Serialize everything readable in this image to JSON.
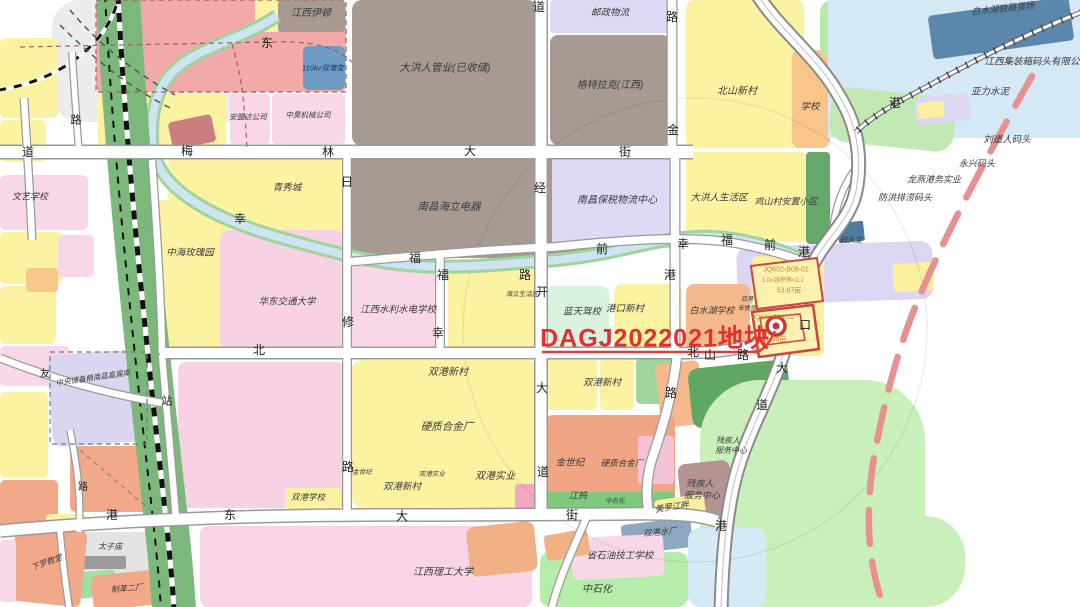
{
  "meta": {
    "title": "城市规划地块示意图",
    "highlight_parcel_label": "DAGJ2022021地块",
    "parcels": [
      {
        "code": "JQ602-B08-01",
        "far": "1.0<容积率<2.2",
        "area": "53.67亩"
      },
      {
        "code": "JQ602-B08-02",
        "area": "39.99亩"
      }
    ]
  },
  "colors": {
    "highlight": "#e23030",
    "parcel_outline": "#cc4444",
    "red_dashed": "#e89090",
    "river": "#cfe4f2",
    "river_bank": "#9fd49a",
    "railway_green": "#7cb87c",
    "road": "#ffffff",
    "road_casing": "#9a9a9a"
  },
  "blocks": [
    {
      "x": 52,
      "y": 0,
      "w": 205,
      "h": 122,
      "c": "#ececec",
      "r": 28,
      "n": "rail-yard"
    },
    {
      "x": 0,
      "y": 38,
      "w": 58,
      "h": 80,
      "c": "#fcf3a2",
      "r": 6
    },
    {
      "x": 0,
      "y": 120,
      "w": 46,
      "h": 42,
      "c": "#fcf3a2",
      "r": 6
    },
    {
      "x": 96,
      "y": 0,
      "w": 250,
      "h": 92,
      "c": "#f1a9a9",
      "r": 6
    },
    {
      "x": 255,
      "y": 0,
      "w": 24,
      "h": 32,
      "c": "#fcf3a2",
      "r": 3
    },
    {
      "x": 278,
      "y": 0,
      "w": 67,
      "h": 32,
      "c": "#a79a92",
      "r": 4
    },
    {
      "x": 303,
      "y": 46,
      "w": 42,
      "h": 44,
      "c": "#6d9cc4",
      "r": 6
    },
    {
      "x": 98,
      "y": 94,
      "w": 128,
      "h": 52,
      "c": "#fcf3a2",
      "r": 4
    },
    {
      "x": 230,
      "y": 94,
      "w": 40,
      "h": 50,
      "c": "#f8d8e8",
      "r": 4
    },
    {
      "x": 272,
      "y": 94,
      "w": 73,
      "h": 50,
      "c": "#f8d8e8",
      "r": 4
    },
    {
      "x": 170,
      "y": 118,
      "w": 44,
      "h": 28,
      "c": "#c97f7f",
      "r": 4,
      "a": -12
    },
    {
      "x": 352,
      "y": 0,
      "w": 186,
      "h": 146,
      "c": "#a79a92",
      "r": 10
    },
    {
      "x": 550,
      "y": 0,
      "w": 120,
      "h": 33,
      "c": "#ded9f4",
      "r": 4
    },
    {
      "x": 550,
      "y": 35,
      "w": 120,
      "h": 110,
      "c": "#a79a92",
      "r": 8
    },
    {
      "x": 686,
      "y": 0,
      "w": 118,
      "h": 148,
      "c": "#fcf3a2",
      "r": 8
    },
    {
      "x": 792,
      "y": 50,
      "w": 38,
      "h": 98,
      "c": "#f8c58c",
      "r": 8
    },
    {
      "x": 820,
      "y": 0,
      "w": 70,
      "h": 58,
      "c": "#b9e8ab",
      "r": 12
    },
    {
      "x": 828,
      "y": 0,
      "w": 252,
      "h": 138,
      "c": "#d5e8f5",
      "r": 0,
      "n": "lake"
    },
    {
      "x": 930,
      "y": 6,
      "w": 142,
      "h": 44,
      "c": "#5b87ad",
      "r": 4,
      "a": -8
    },
    {
      "x": 830,
      "y": 92,
      "w": 125,
      "h": 55,
      "c": "#c2e9b4",
      "r": 18,
      "a": 6
    },
    {
      "x": 915,
      "y": 95,
      "w": 55,
      "h": 28,
      "c": "#ddd8f2",
      "r": 8,
      "a": -6
    },
    {
      "x": 918,
      "y": 102,
      "w": 26,
      "h": 16,
      "c": "#faf0a0",
      "r": 3,
      "a": -6
    },
    {
      "x": 168,
      "y": 155,
      "w": 177,
      "h": 92,
      "c": "#fcf3a2",
      "r": 10
    },
    {
      "x": 148,
      "y": 200,
      "w": 100,
      "h": 150,
      "c": "#fcf3a2",
      "r": 12
    },
    {
      "x": 220,
      "y": 230,
      "w": 125,
      "h": 120,
      "c": "#f6d2e4",
      "r": 10
    },
    {
      "x": 352,
      "y": 150,
      "w": 268,
      "h": 108,
      "c": "#a79a92",
      "r": 10
    },
    {
      "x": 552,
      "y": 153,
      "w": 128,
      "h": 95,
      "c": "#ded9f4",
      "r": 8
    },
    {
      "x": 686,
      "y": 152,
      "w": 122,
      "h": 90,
      "c": "#fcf3a2",
      "r": 8
    },
    {
      "x": 806,
      "y": 152,
      "w": 24,
      "h": 92,
      "c": "#66a86a",
      "r": 4
    },
    {
      "x": 737,
      "y": 244,
      "w": 196,
      "h": 58,
      "c": "#dcd6f2",
      "r": 12,
      "a": -2
    },
    {
      "x": 893,
      "y": 263,
      "w": 40,
      "h": 28,
      "c": "#faf0a0",
      "r": 4,
      "a": -4
    },
    {
      "x": 838,
      "y": 222,
      "w": 26,
      "h": 20,
      "c": "#4f7ba3",
      "r": 2,
      "a": -6
    },
    {
      "x": 0,
      "y": 175,
      "w": 88,
      "h": 55,
      "c": "#f8d8e8",
      "r": 6
    },
    {
      "x": 0,
      "y": 232,
      "w": 62,
      "h": 52,
      "c": "#fcf3a2",
      "r": 5
    },
    {
      "x": 0,
      "y": 286,
      "w": 56,
      "h": 58,
      "c": "#fcf3a2",
      "r": 5
    },
    {
      "x": 58,
      "y": 235,
      "w": 36,
      "h": 42,
      "c": "#f8d8e8",
      "r": 5
    },
    {
      "x": 26,
      "y": 268,
      "w": 32,
      "h": 24,
      "c": "#f5c98a",
      "r": 4
    },
    {
      "x": 0,
      "y": 346,
      "w": 70,
      "h": 40,
      "c": "#f8d8e8",
      "r": 5
    },
    {
      "x": 352,
      "y": 262,
      "w": 90,
      "h": 90,
      "c": "#f8d8e8",
      "r": 8
    },
    {
      "x": 448,
      "y": 262,
      "w": 88,
      "h": 90,
      "c": "#fcf3a2",
      "r": 8
    },
    {
      "x": 545,
      "y": 286,
      "w": 64,
      "h": 62,
      "c": "#d9f2e0",
      "r": 8
    },
    {
      "x": 614,
      "y": 284,
      "w": 68,
      "h": 64,
      "c": "#fcf3a2",
      "r": 8
    },
    {
      "x": 686,
      "y": 284,
      "w": 64,
      "h": 68,
      "c": "#f5b98c",
      "r": 8
    },
    {
      "x": 752,
      "y": 256,
      "w": 72,
      "h": 100,
      "c": "#faf0a0",
      "r": 6
    },
    {
      "x": 178,
      "y": 362,
      "w": 167,
      "h": 146,
      "c": "#f6d2e4",
      "r": 8
    },
    {
      "x": 50,
      "y": 352,
      "w": 97,
      "h": 92,
      "c": "#dbd6f0",
      "r": 10,
      "a": -4
    },
    {
      "x": 70,
      "y": 446,
      "w": 82,
      "h": 66,
      "c": "#f2a989",
      "r": 6
    },
    {
      "x": 0,
      "y": 392,
      "w": 48,
      "h": 86,
      "c": "#fcf3a2",
      "r": 5
    },
    {
      "x": 0,
      "y": 480,
      "w": 58,
      "h": 52,
      "c": "#f2a989",
      "r": 5
    },
    {
      "x": 46,
      "y": 514,
      "w": 40,
      "h": 22,
      "c": "#fcf3a2",
      "r": 4
    },
    {
      "x": 352,
      "y": 360,
      "w": 185,
      "h": 148,
      "c": "#fcf3a2",
      "r": 10
    },
    {
      "x": 515,
      "y": 484,
      "w": 24,
      "h": 26,
      "c": "#f2a8c0",
      "r": 3
    },
    {
      "x": 545,
      "y": 358,
      "w": 52,
      "h": 52,
      "c": "#fcf3a2",
      "r": 6
    },
    {
      "x": 600,
      "y": 358,
      "w": 34,
      "h": 52,
      "c": "#fcf3a2",
      "r": 6
    },
    {
      "x": 636,
      "y": 358,
      "w": 42,
      "h": 46,
      "c": "#9ed69e",
      "r": 5
    },
    {
      "x": 658,
      "y": 362,
      "w": 44,
      "h": 64,
      "c": "#f5b98c",
      "r": 6,
      "a": -6
    },
    {
      "x": 690,
      "y": 364,
      "w": 100,
      "h": 60,
      "c": "#5fa763",
      "r": 10,
      "a": -6
    },
    {
      "x": 545,
      "y": 415,
      "w": 130,
      "h": 96,
      "c": "#f0a585",
      "r": 8
    },
    {
      "x": 545,
      "y": 492,
      "w": 130,
      "h": 20,
      "c": "#7fc87f",
      "r": 4
    },
    {
      "x": 638,
      "y": 436,
      "w": 36,
      "h": 48,
      "c": "#f3c3d8",
      "r": 4
    },
    {
      "x": 700,
      "y": 380,
      "w": 225,
      "h": 235,
      "c": "#c9f0bb",
      "r": 60
    },
    {
      "x": 700,
      "y": 516,
      "w": 265,
      "h": 91,
      "c": "#c9f0bb",
      "r": 40
    },
    {
      "x": 680,
      "y": 462,
      "w": 52,
      "h": 58,
      "c": "#b49393",
      "r": 8,
      "a": -6
    },
    {
      "x": 655,
      "y": 497,
      "w": 50,
      "h": 20,
      "c": "#faf0a0",
      "r": 4,
      "a": -8
    },
    {
      "x": 622,
      "y": 521,
      "w": 70,
      "h": 30,
      "c": "#8fa8c0",
      "r": 4,
      "a": -7
    },
    {
      "x": 688,
      "y": 528,
      "w": 78,
      "h": 79,
      "c": "#d6e9f6",
      "r": 12
    },
    {
      "x": 540,
      "y": 552,
      "w": 148,
      "h": 55,
      "c": "#b4eeaa",
      "r": 10
    },
    {
      "x": 572,
      "y": 536,
      "w": 92,
      "h": 42,
      "c": "#f8d8e8",
      "r": 6,
      "a": -3
    },
    {
      "x": 200,
      "y": 526,
      "w": 332,
      "h": 81,
      "c": "#f8d5e6",
      "r": 8
    },
    {
      "x": 468,
      "y": 524,
      "w": 68,
      "h": 50,
      "c": "#f2b185",
      "r": 8,
      "a": -6
    },
    {
      "x": 545,
      "y": 532,
      "w": 44,
      "h": 26,
      "c": "#f2b185",
      "r": 4,
      "a": -10
    },
    {
      "x": 62,
      "y": 532,
      "w": 102,
      "h": 44,
      "c": "#e3e3e3",
      "r": 8
    },
    {
      "x": 80,
      "y": 556,
      "w": 46,
      "h": 13,
      "c": "#9a9a9a",
      "r": 2
    },
    {
      "x": 58,
      "y": 572,
      "w": 58,
      "h": 26,
      "c": "#9fe09f",
      "r": 4,
      "a": -6
    },
    {
      "x": 92,
      "y": 572,
      "w": 78,
      "h": 35,
      "c": "#f2a989",
      "r": 6,
      "a": -6
    },
    {
      "x": 12,
      "y": 528,
      "w": 72,
      "h": 76,
      "c": "#f2a989",
      "r": 6,
      "a": 6
    },
    {
      "x": 0,
      "y": 540,
      "w": 16,
      "h": 62,
      "c": "#f8d8e8",
      "r": 3
    },
    {
      "x": 285,
      "y": 488,
      "w": 56,
      "h": 22,
      "c": "#fcf3a2",
      "r": 4
    }
  ],
  "labels": [
    {
      "t": "道",
      "x": 28,
      "y": 152,
      "s": 12,
      "c": "#1c1c1c"
    },
    {
      "t": "路",
      "x": 76,
      "y": 121,
      "s": 11,
      "c": "#1c1c1c"
    },
    {
      "t": "东",
      "x": 267,
      "y": 43,
      "s": 12,
      "c": "#1c1c1c"
    },
    {
      "t": "梅",
      "x": 187,
      "y": 151,
      "s": 12,
      "c": "#1c1c1c"
    },
    {
      "t": "林",
      "x": 328,
      "y": 152,
      "s": 12,
      "c": "#1c1c1c"
    },
    {
      "t": "大",
      "x": 470,
      "y": 151,
      "s": 12,
      "c": "#1c1c1c"
    },
    {
      "t": "街",
      "x": 625,
      "y": 152,
      "s": 12,
      "c": "#1c1c1c"
    },
    {
      "t": "道",
      "x": 539,
      "y": 7,
      "s": 12,
      "c": "#1c1c1c"
    },
    {
      "t": "路",
      "x": 672,
      "y": 17,
      "s": 12,
      "c": "#1c1c1c"
    },
    {
      "t": "金",
      "x": 673,
      "y": 130,
      "s": 12,
      "c": "#1c1c1c"
    },
    {
      "t": "港",
      "x": 895,
      "y": 103,
      "s": 12,
      "c": "#1c1c1c"
    },
    {
      "t": "经",
      "x": 540,
      "y": 188,
      "s": 12,
      "c": "#1c1c1c"
    },
    {
      "t": "开",
      "x": 542,
      "y": 292,
      "s": 12,
      "c": "#1c1c1c"
    },
    {
      "t": "大",
      "x": 542,
      "y": 388,
      "s": 12,
      "c": "#1c1c1c"
    },
    {
      "t": "道",
      "x": 543,
      "y": 472,
      "s": 12,
      "c": "#1c1c1c"
    },
    {
      "t": "日",
      "x": 347,
      "y": 182,
      "s": 12,
      "c": "#1c1c1c"
    },
    {
      "t": "修",
      "x": 348,
      "y": 322,
      "s": 12,
      "c": "#1c1c1c"
    },
    {
      "t": "路",
      "x": 348,
      "y": 467,
      "s": 12,
      "c": "#1c1c1c"
    },
    {
      "t": "幸",
      "x": 240,
      "y": 219,
      "s": 12,
      "c": "#1c1c1c"
    },
    {
      "t": "福",
      "x": 415,
      "y": 258,
      "s": 12,
      "c": "#1c1c1c"
    },
    {
      "t": "路",
      "x": 525,
      "y": 275,
      "s": 12,
      "c": "#1c1c1c"
    },
    {
      "t": "前",
      "x": 602,
      "y": 249,
      "s": 12,
      "c": "#1c1c1c"
    },
    {
      "t": "幸",
      "x": 683,
      "y": 244,
      "s": 12,
      "c": "#1c1c1c"
    },
    {
      "t": "福",
      "x": 727,
      "y": 240,
      "s": 12,
      "c": "#1c1c1c"
    },
    {
      "t": "前",
      "x": 770,
      "y": 245,
      "s": 12,
      "c": "#1c1c1c"
    },
    {
      "t": "港",
      "x": 804,
      "y": 252,
      "s": 12,
      "c": "#1c1c1c"
    },
    {
      "t": "港",
      "x": 670,
      "y": 275,
      "s": 12,
      "c": "#1c1c1c"
    },
    {
      "t": "路",
      "x": 671,
      "y": 393,
      "s": 12,
      "c": "#1c1c1c"
    },
    {
      "t": "北",
      "x": 259,
      "y": 350,
      "s": 12,
      "c": "#1c1c1c"
    },
    {
      "t": "北",
      "x": 693,
      "y": 352,
      "s": 12,
      "c": "#1c1c1c"
    },
    {
      "t": "山",
      "x": 710,
      "y": 355,
      "s": 12,
      "c": "#1c1c1c"
    },
    {
      "t": "路",
      "x": 743,
      "y": 355,
      "s": 12,
      "c": "#1c1c1c"
    },
    {
      "t": "口",
      "x": 805,
      "y": 325,
      "s": 12,
      "c": "#1c1c1c"
    },
    {
      "t": "大",
      "x": 782,
      "y": 368,
      "s": 12,
      "c": "#1c1c1c"
    },
    {
      "t": "道",
      "x": 762,
      "y": 405,
      "s": 12,
      "c": "#1c1c1c"
    },
    {
      "t": "港",
      "x": 112,
      "y": 515,
      "s": 12,
      "c": "#1c1c1c"
    },
    {
      "t": "东",
      "x": 230,
      "y": 515,
      "s": 12,
      "c": "#1c1c1c"
    },
    {
      "t": "大",
      "x": 402,
      "y": 516,
      "s": 12,
      "c": "#1c1c1c"
    },
    {
      "t": "街",
      "x": 572,
      "y": 515,
      "s": 12,
      "c": "#1c1c1c"
    },
    {
      "t": "站",
      "x": 167,
      "y": 402,
      "s": 11,
      "c": "#1c1c1c"
    },
    {
      "t": "港",
      "x": 721,
      "y": 526,
      "s": 12,
      "c": "#1c1c1c"
    },
    {
      "t": "友",
      "x": 45,
      "y": 375,
      "s": 10,
      "c": "#1c1c1c"
    },
    {
      "t": "路",
      "x": 83,
      "y": 488,
      "s": 10,
      "c": "#1c1c1c"
    },
    {
      "t": "福",
      "x": 443,
      "y": 275,
      "s": 12,
      "c": "#1c1c1c"
    },
    {
      "t": "幸",
      "x": 438,
      "y": 333,
      "s": 12,
      "c": "#1c1c1c"
    },
    {
      "t": "江西伊顿",
      "x": 311,
      "y": 14,
      "s": 10,
      "i": 1
    },
    {
      "t": "110kv双港变",
      "x": 323,
      "y": 68,
      "s": 7.5,
      "c": "#16324f",
      "i": 1
    },
    {
      "t": "安盟达公司",
      "x": 248,
      "y": 117,
      "s": 7.5,
      "i": 1
    },
    {
      "t": "中昊机械公司",
      "x": 308,
      "y": 115,
      "s": 7.5,
      "i": 1
    },
    {
      "t": "大洪人管业(已收储)",
      "x": 445,
      "y": 68,
      "s": 10.5,
      "i": 1
    },
    {
      "t": "邮政物流",
      "x": 610,
      "y": 13,
      "s": 9.5,
      "i": 1
    },
    {
      "t": "格特拉克(江西)",
      "x": 610,
      "y": 86,
      "s": 10,
      "i": 1
    },
    {
      "t": "北山新村",
      "x": 737,
      "y": 92,
      "s": 10,
      "i": 1
    },
    {
      "t": "学校",
      "x": 810,
      "y": 107,
      "s": 9.5,
      "i": 1
    },
    {
      "t": "白水湖铁路货场",
      "x": 1003,
      "y": 9,
      "s": 9,
      "a": -6,
      "i": 1
    },
    {
      "t": "江西集装箱码头有限公",
      "x": 1032,
      "y": 62,
      "s": 9.5,
      "i": 1
    },
    {
      "t": "亚力水泥",
      "x": 990,
      "y": 92,
      "s": 9.5,
      "i": 1
    },
    {
      "t": "刘道人码头",
      "x": 1007,
      "y": 140,
      "s": 9.5,
      "i": 1
    },
    {
      "t": "永兴码头",
      "x": 977,
      "y": 164,
      "s": 9,
      "i": 1
    },
    {
      "t": "龙燕港务实业",
      "x": 934,
      "y": 180,
      "s": 9,
      "i": 1
    },
    {
      "t": "防洪排涝码头",
      "x": 905,
      "y": 198,
      "s": 9,
      "i": 1
    },
    {
      "t": "码头变",
      "x": 851,
      "y": 240,
      "s": 7.5,
      "i": 1
    },
    {
      "t": "文艺学校",
      "x": 30,
      "y": 197,
      "s": 9,
      "i": 1
    },
    {
      "t": "青秀城",
      "x": 287,
      "y": 188,
      "s": 9.5,
      "i": 1
    },
    {
      "t": "中海玫瑰园",
      "x": 190,
      "y": 253,
      "s": 9.5,
      "i": 1
    },
    {
      "t": "华东交通大学",
      "x": 287,
      "y": 302,
      "s": 9.5,
      "i": 1
    },
    {
      "t": "南昌海立电器",
      "x": 449,
      "y": 207,
      "s": 10.5,
      "i": 1
    },
    {
      "t": "海立生活区",
      "x": 522,
      "y": 295,
      "s": 6.5,
      "i": 1
    },
    {
      "t": "江西水利水电学校",
      "x": 398,
      "y": 310,
      "s": 9.5,
      "i": 1
    },
    {
      "t": "南昌保税物流中心",
      "x": 617,
      "y": 201,
      "s": 10,
      "i": 1
    },
    {
      "t": "大洪人生活区",
      "x": 719,
      "y": 198,
      "s": 9.5,
      "i": 1
    },
    {
      "t": "鸡山村安置小区",
      "x": 786,
      "y": 202,
      "s": 9,
      "i": 1
    },
    {
      "t": "蓝天驾校",
      "x": 582,
      "y": 312,
      "s": 9.5,
      "i": 1
    },
    {
      "t": "港口新村",
      "x": 625,
      "y": 309,
      "s": 9.5,
      "i": 1
    },
    {
      "t": "白水湖学校",
      "x": 712,
      "y": 311,
      "s": 9,
      "i": 1
    },
    {
      "t": "双港",
      "x": 747,
      "y": 300,
      "s": 6,
      "i": 1
    },
    {
      "t": "安置房",
      "x": 747,
      "y": 309,
      "s": 6,
      "i": 1
    },
    {
      "t": "JQ602-B08-01",
      "x": 786,
      "y": 270,
      "s": 7,
      "c": "#c8823c"
    },
    {
      "t": "1.0<容积率<2.2",
      "x": 783,
      "y": 281,
      "s": 6,
      "c": "#c8823c"
    },
    {
      "t": "53.67亩",
      "x": 789,
      "y": 291,
      "s": 7,
      "c": "#c8823c"
    },
    {
      "t": "JQ602-B08-02",
      "x": 773,
      "y": 318,
      "s": 6.5,
      "c": "#c8823c"
    },
    {
      "t": "39.99亩",
      "x": 774,
      "y": 340,
      "s": 7,
      "c": "#c8823c"
    },
    {
      "t": "DAGJ2022021地块",
      "x": 655,
      "y": 339,
      "s": 25,
      "c": "#e23030",
      "b": 1,
      "n": "highlight-parcel-label"
    },
    {
      "t": "双港新村",
      "x": 448,
      "y": 373,
      "s": 10,
      "i": 1
    },
    {
      "t": "硬质合金厂",
      "x": 447,
      "y": 427,
      "s": 10.5,
      "i": 1
    },
    {
      "t": "双港实业",
      "x": 495,
      "y": 477,
      "s": 10,
      "i": 1
    },
    {
      "t": "双港新村",
      "x": 402,
      "y": 487,
      "s": 9.5,
      "i": 1
    },
    {
      "t": "金世纪",
      "x": 362,
      "y": 473,
      "s": 6.5,
      "i": 1
    },
    {
      "t": "双港实业",
      "x": 432,
      "y": 475,
      "s": 6.5,
      "i": 1
    },
    {
      "t": "双港新村",
      "x": 602,
      "y": 383,
      "s": 9.5,
      "i": 1
    },
    {
      "t": "金世纪",
      "x": 570,
      "y": 463,
      "s": 9.5,
      "i": 1
    },
    {
      "t": "硬质合金厂",
      "x": 622,
      "y": 463,
      "s": 8.5,
      "i": 1
    },
    {
      "t": "江钨",
      "x": 578,
      "y": 496,
      "s": 9,
      "i": 1
    },
    {
      "t": "中石化",
      "x": 615,
      "y": 502,
      "s": 6.5,
      "i": 1
    },
    {
      "t": "美罗江畔",
      "x": 672,
      "y": 507,
      "s": 8.5,
      "a": -8,
      "i": 1
    },
    {
      "t": "残疾人",
      "x": 728,
      "y": 441,
      "s": 8,
      "i": 1
    },
    {
      "t": "服务中心",
      "x": 731,
      "y": 451,
      "s": 8,
      "i": 1
    },
    {
      "t": "残疾人",
      "x": 700,
      "y": 484,
      "s": 9,
      "i": 1
    },
    {
      "t": "服务中心",
      "x": 702,
      "y": 496,
      "s": 9,
      "i": 1
    },
    {
      "t": "双港水厂",
      "x": 660,
      "y": 532,
      "s": 8.5,
      "a": -5,
      "i": 1
    },
    {
      "t": "省石油技工学校",
      "x": 620,
      "y": 556,
      "s": 9.5,
      "i": 1
    },
    {
      "t": "中石化",
      "x": 597,
      "y": 590,
      "s": 10,
      "i": 1
    },
    {
      "t": "江西理工大学",
      "x": 443,
      "y": 573,
      "s": 10,
      "i": 1
    },
    {
      "t": "双港学校",
      "x": 308,
      "y": 497,
      "s": 8.5,
      "i": 1
    },
    {
      "t": "中央储备粮南昌直属库",
      "x": 93,
      "y": 378,
      "s": 7.5,
      "a": -8,
      "i": 1
    },
    {
      "t": "太子庙",
      "x": 110,
      "y": 547,
      "s": 8,
      "i": 1
    },
    {
      "t": "制革二厂",
      "x": 127,
      "y": 589,
      "s": 8,
      "a": -5,
      "i": 1
    },
    {
      "t": "下罗教堂",
      "x": 47,
      "y": 563,
      "s": 8,
      "a": -20,
      "i": 1
    }
  ]
}
